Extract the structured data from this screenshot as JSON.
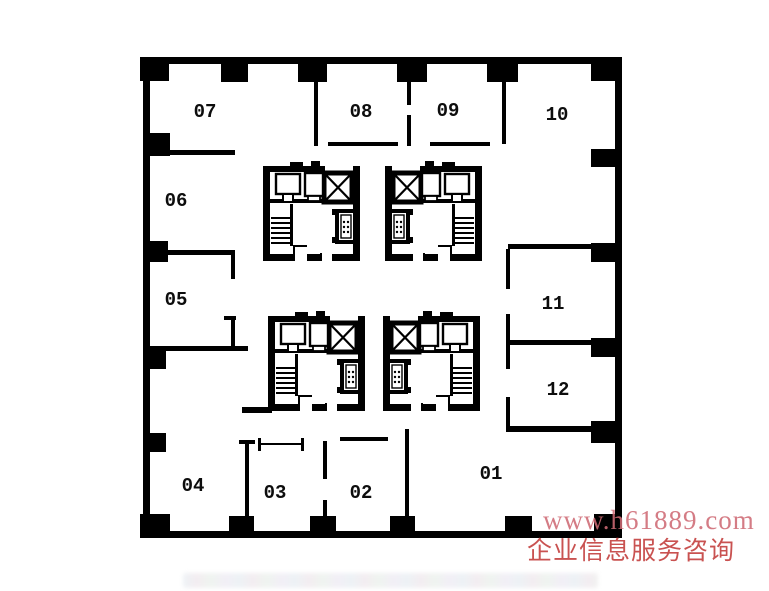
{
  "plan": {
    "title": "office-floor-plan",
    "rooms": [
      "07",
      "08",
      "09",
      "10",
      "06",
      "05",
      "11",
      "12",
      "04",
      "03",
      "02",
      "01"
    ],
    "wall_color": "#000000",
    "core_features": [
      "elevator-shaft",
      "elevator-car",
      "stairs",
      "restroom-fixtures"
    ]
  },
  "watermark": {
    "url_text": "www.h61889.com",
    "service_text": "企业信息服务咨询",
    "url_color": "#cf6a75",
    "service_color": "#c4403f"
  }
}
